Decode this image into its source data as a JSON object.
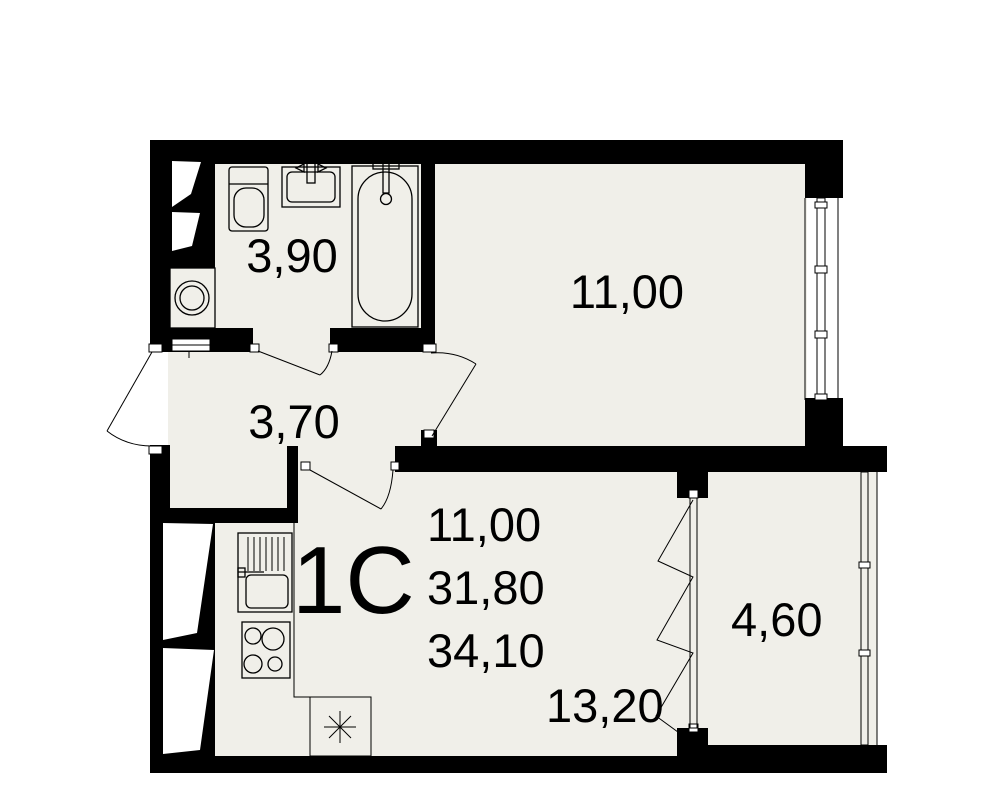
{
  "apartment": {
    "type_label": "1С",
    "area_summary": {
      "living": "11,00",
      "secondary": "31,80",
      "total": "34,10"
    }
  },
  "rooms": {
    "bathroom": {
      "area": "3,90"
    },
    "hallway": {
      "area": "3,70"
    },
    "living_room": {
      "area": "11,00"
    },
    "kitchen_living": {
      "area": "13,20"
    },
    "balcony": {
      "area": "4,60"
    }
  },
  "colors": {
    "wall": "#000000",
    "floor": "#f0efe9",
    "background": "#ffffff",
    "line": "#000000"
  }
}
